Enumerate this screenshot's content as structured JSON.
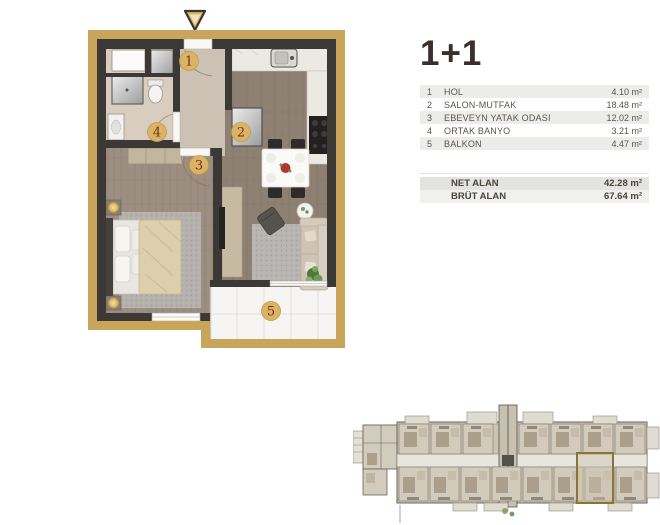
{
  "panel": {
    "title": "1+1",
    "rooms": [
      {
        "num": "1",
        "name": "HOL",
        "area": "4.10 m²"
      },
      {
        "num": "2",
        "name": "SALON-MUTFAK",
        "area": "18.48 m²"
      },
      {
        "num": "3",
        "name": "EBEVEYN YATAK ODASI",
        "area": "12.02 m²"
      },
      {
        "num": "4",
        "name": "ORTAK BANYO",
        "area": "3.21 m²"
      },
      {
        "num": "5",
        "name": "BALKON",
        "area": "4.47 m²"
      }
    ],
    "totals": [
      {
        "label": "NET ALAN",
        "value": "42.28 m²"
      },
      {
        "label": "BRÜT ALAN",
        "value": "67.64 m²"
      }
    ]
  },
  "plan": {
    "markers": [
      "1",
      "2",
      "3",
      "4",
      "5"
    ]
  },
  "colors": {
    "gold_frame": "#C9A55C",
    "wall": "#3B3835",
    "marker_fill": "#D9B466",
    "marker_text": "#772F1B",
    "title_text": "#3A2F2B",
    "row_stripe": "#ECECEA",
    "net_row": "#E3E3E1",
    "brut_row": "#F0F0EE"
  }
}
